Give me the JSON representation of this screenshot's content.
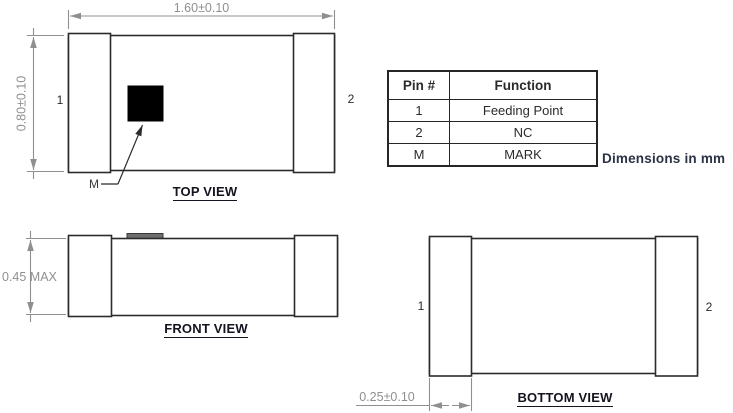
{
  "note": "Dimensions in mm",
  "views": {
    "top": {
      "title": "TOP VIEW",
      "width_dim": "1.60±0.10",
      "height_dim": "0.80±0.10",
      "pin1": "1",
      "pin2": "2",
      "mark_label": "M"
    },
    "front": {
      "title": "FRONT VIEW",
      "height_dim": "0.45 MAX"
    },
    "bottom": {
      "title": "BOTTOM VIEW",
      "pin1": "1",
      "pin2": "2",
      "terminal_width_dim": "0.25±0.10"
    }
  },
  "pin_table": {
    "headers": [
      "Pin #",
      "Function"
    ],
    "rows": [
      [
        "1",
        "Feeding Point"
      ],
      [
        "2",
        "NC"
      ],
      [
        "M",
        "MARK"
      ]
    ]
  },
  "colors": {
    "outline": "#2b2b2b",
    "dimension": "#8f8f8f",
    "mark_fill": "#000000",
    "note_text": "#2b3245"
  }
}
